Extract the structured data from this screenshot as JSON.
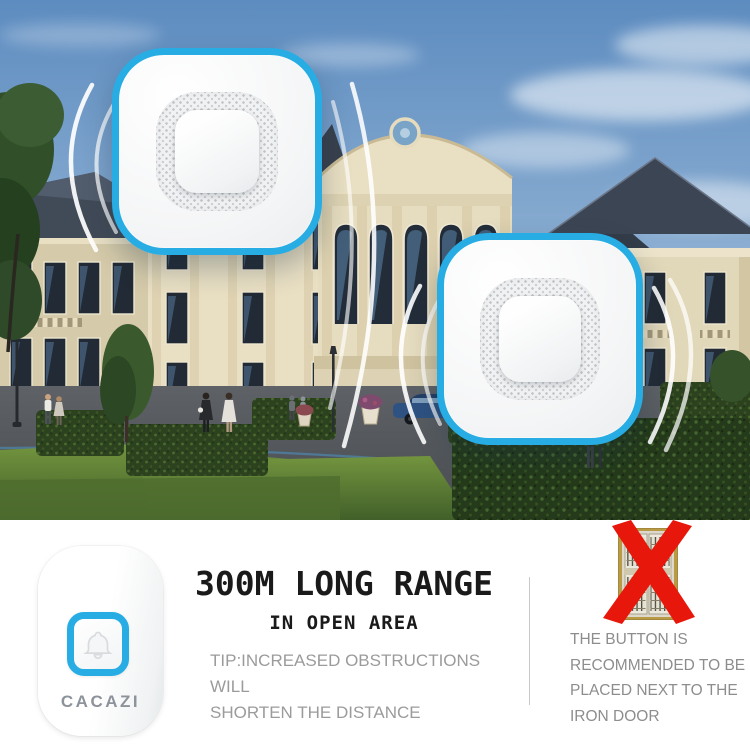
{
  "colors": {
    "accent_blue": "#27ade3",
    "warning_red": "#e8170c",
    "title_black": "#1a1a1a",
    "tip_gray": "#9b9b9b",
    "note_gray": "#8d8d8d",
    "logo_gray": "#8d939a"
  },
  "brand": {
    "logo": "CACAZI"
  },
  "headline": {
    "title": "300M LONG RANGE",
    "subtitle": "IN OPEN AREA",
    "tip_lines": [
      "TIP:INCREASED OBSTRUCTIONS WILL",
      "SHORTEN THE DISTANCE"
    ]
  },
  "warning": {
    "lines": [
      "THE BUTTON IS",
      "RECOMMENDED TO BE",
      "PLACED NEXT TO THE",
      "IRON DOOR"
    ]
  }
}
